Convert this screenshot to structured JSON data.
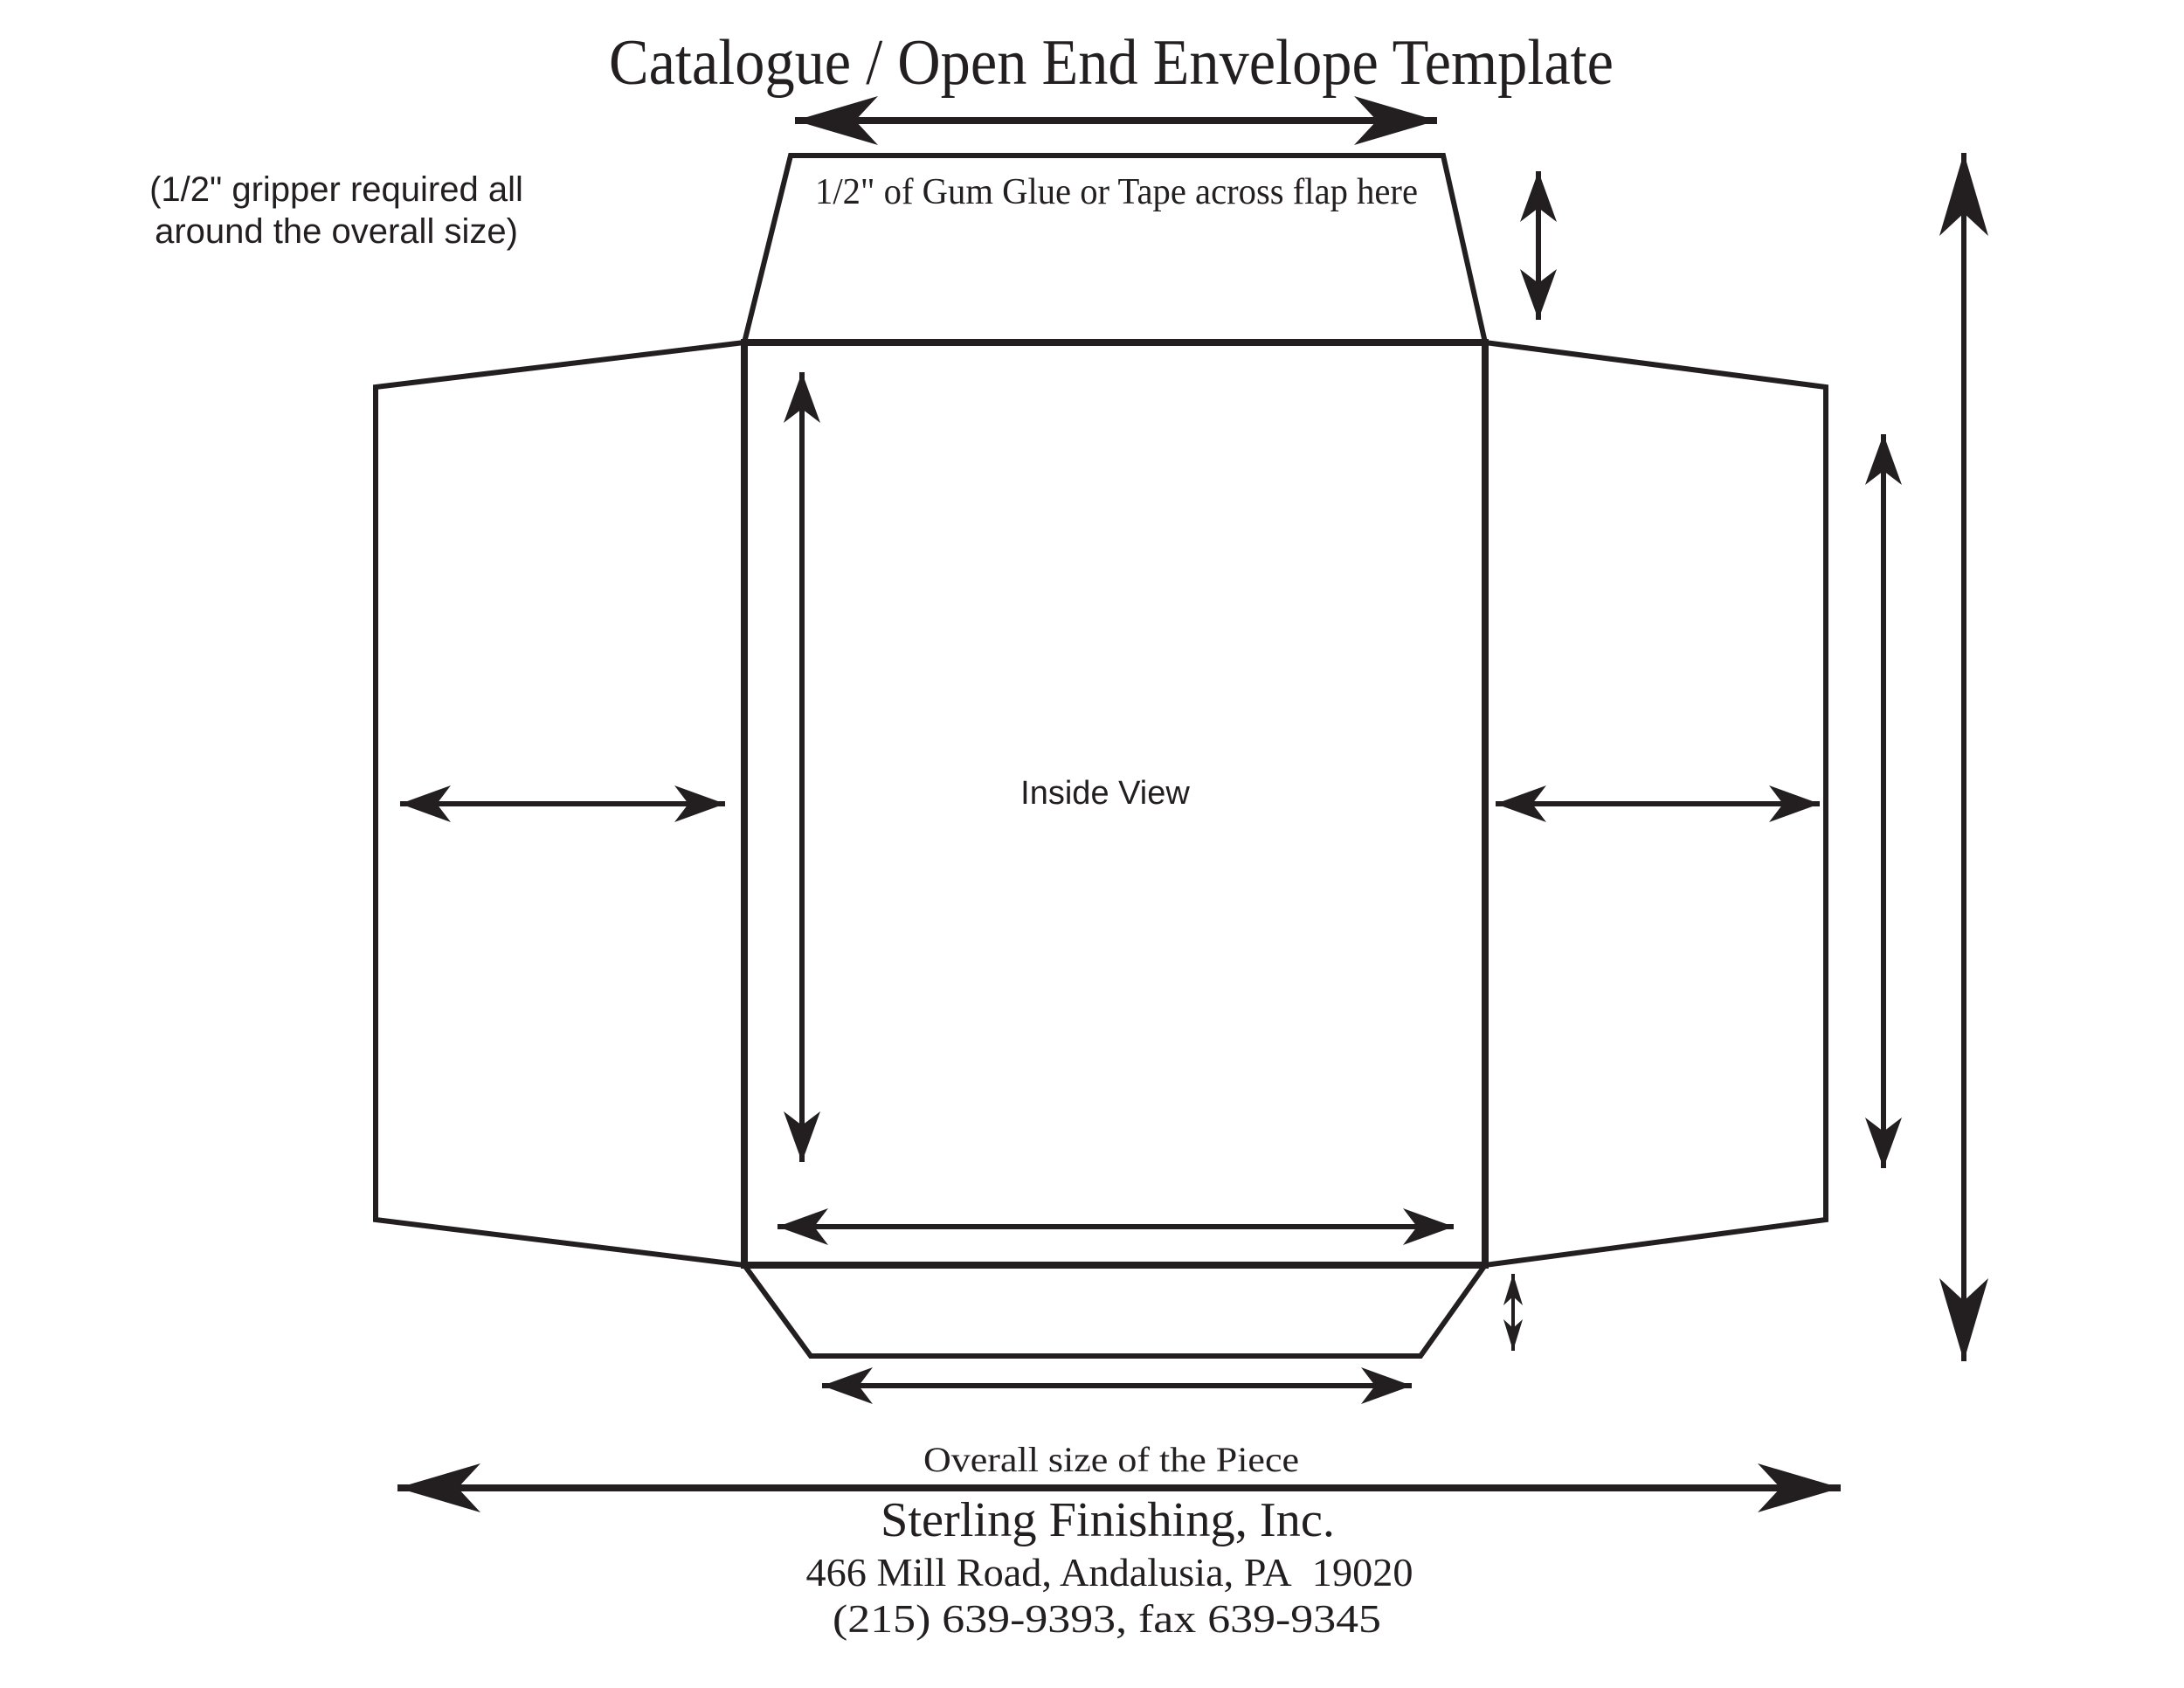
{
  "colors": {
    "ink": "#231f20",
    "paper": "#ffffff"
  },
  "header": {
    "title": "Catalogue / Open End Envelope Template"
  },
  "annotations": {
    "gripper_note_line1": "(1/2\" gripper required all",
    "gripper_note_line2": "around the overall size)",
    "glue_flap_label": "1/2\" of Gum Glue or Tape across flap here",
    "inside_view_label": "Inside View",
    "overall_size_label": "Overall size of the Piece"
  },
  "footer": {
    "company": "Sterling Finishing, Inc.",
    "address": "466 Mill Road, Andalusia, PA  19020",
    "phone": "(215) 639-9393, fax 639-9345"
  }
}
